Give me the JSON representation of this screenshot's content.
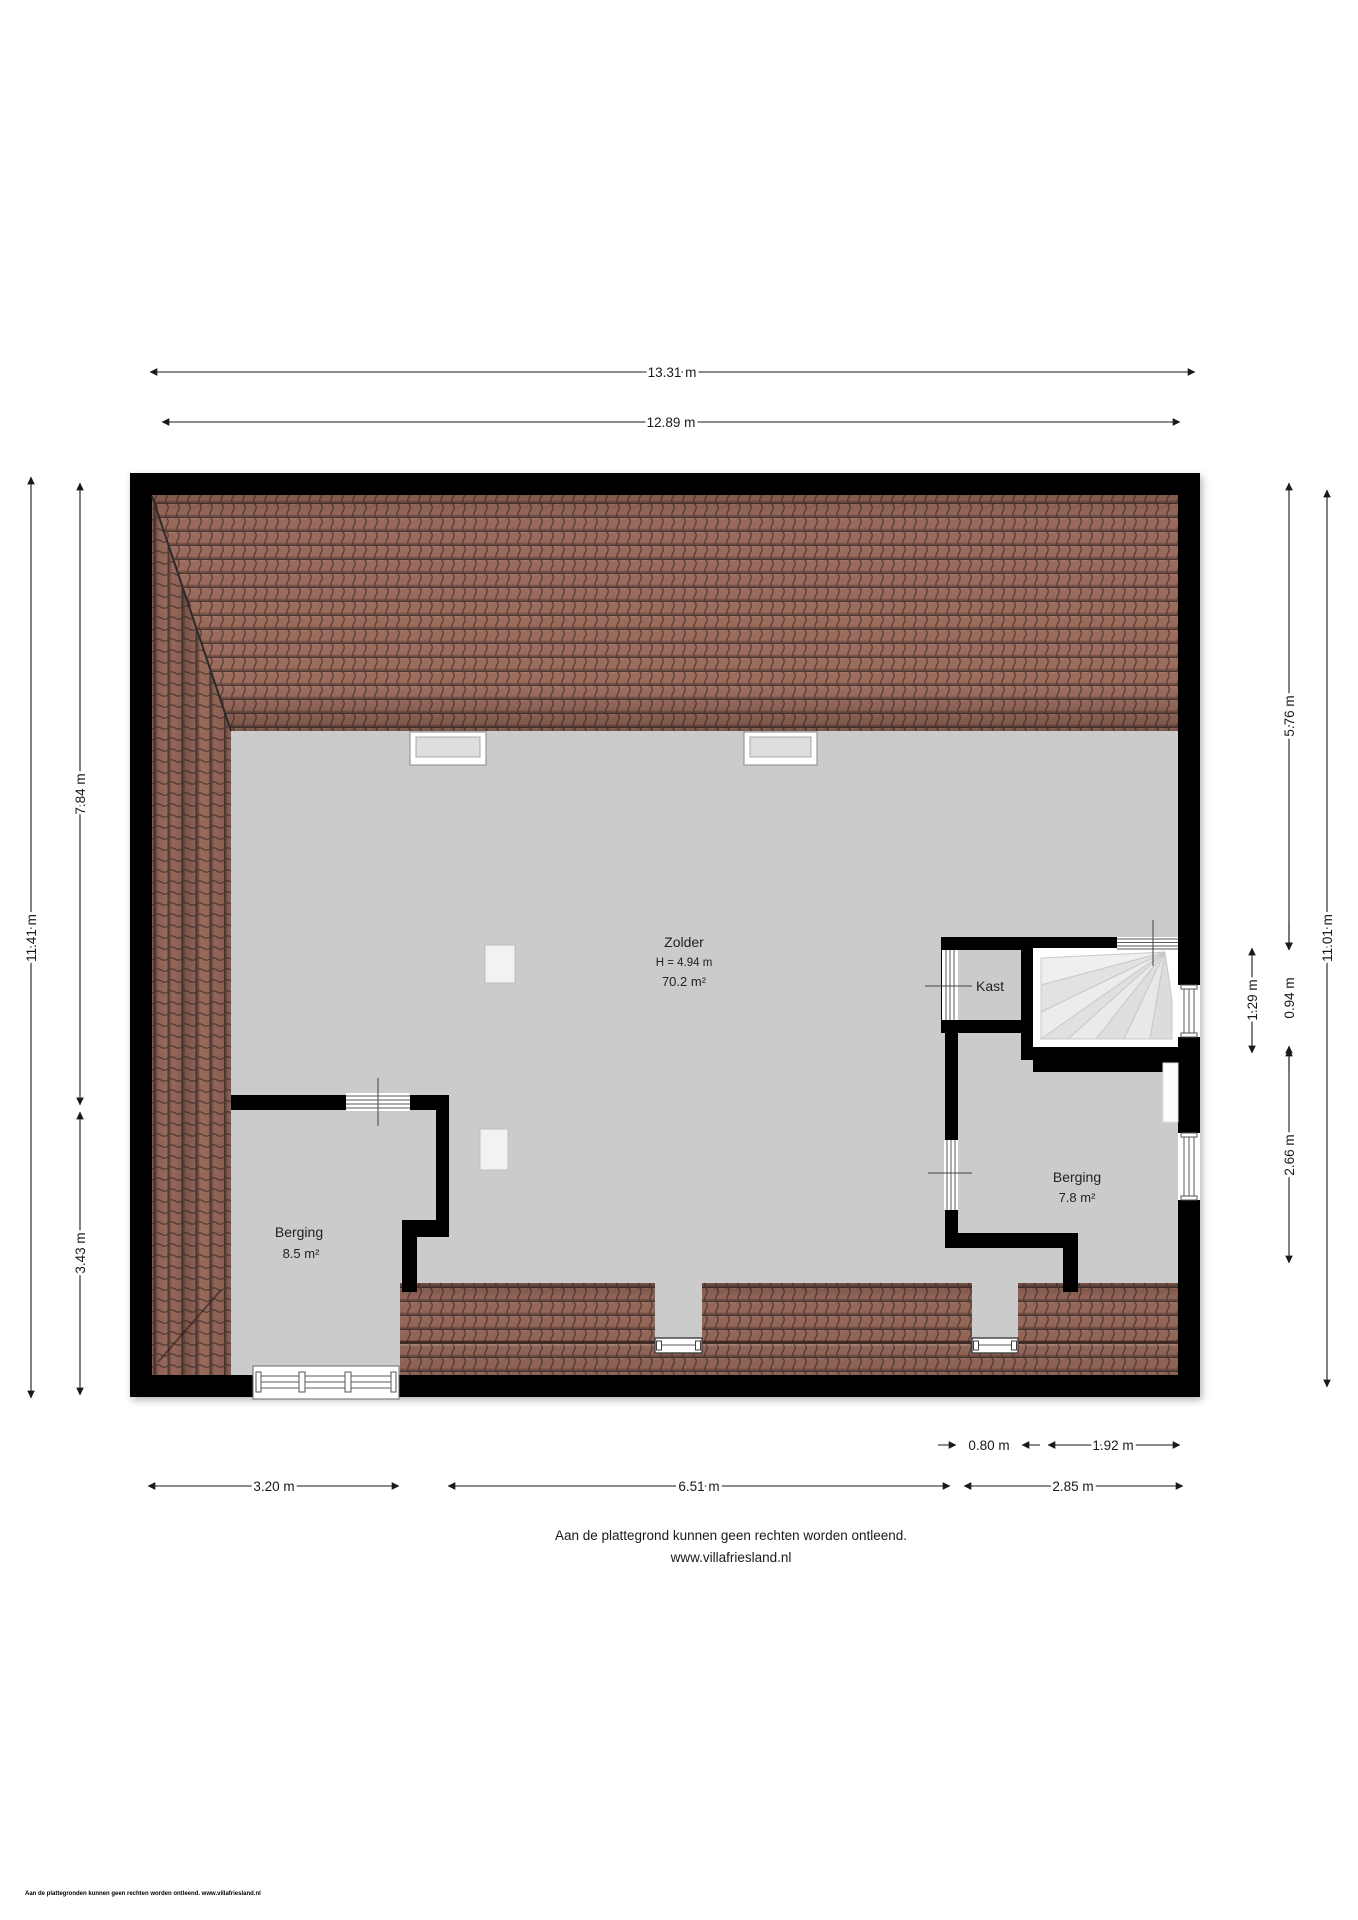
{
  "plan": {
    "rooms": {
      "zolder": {
        "label": "Zolder",
        "height": "H = 4.94 m",
        "area": "70.2 m²"
      },
      "kast": {
        "label": "Kast"
      },
      "berging_left": {
        "label": "Berging",
        "area": "8.5 m²"
      },
      "berging_right": {
        "label": "Berging",
        "area": "7.8 m²"
      }
    },
    "dimensions": {
      "top_outer": "13.31 m",
      "top_inner": "12.89 m",
      "left_total": "11.41 m",
      "left_upper": "7.84 m",
      "left_lower": "3.43 m",
      "right_upper": "5.76 m",
      "right_total": "11.01 m",
      "right_stairwell": "1.29 m",
      "right_kast": "0.94 m",
      "right_berging": "2.66 m",
      "bottom_dormer": "0.80 m",
      "bottom_stair": "1.92 m",
      "bottom_left": "3.20 m",
      "bottom_middle": "6.51 m",
      "bottom_right": "2.85 m"
    },
    "colors": {
      "roof_tile": "#9c6c5d",
      "floor": "#cbcbcb",
      "wall": "#000000",
      "stair_tread": "#e9e9e9"
    }
  },
  "footer": {
    "disclaimer": "Aan de plattegrond kunnen geen rechten worden ontleend.",
    "website": "www.villafriesland.nl"
  },
  "fineprint": "Aan de plattegronden kunnen geen rechten worden ontleend. www.villafriesland.nl"
}
